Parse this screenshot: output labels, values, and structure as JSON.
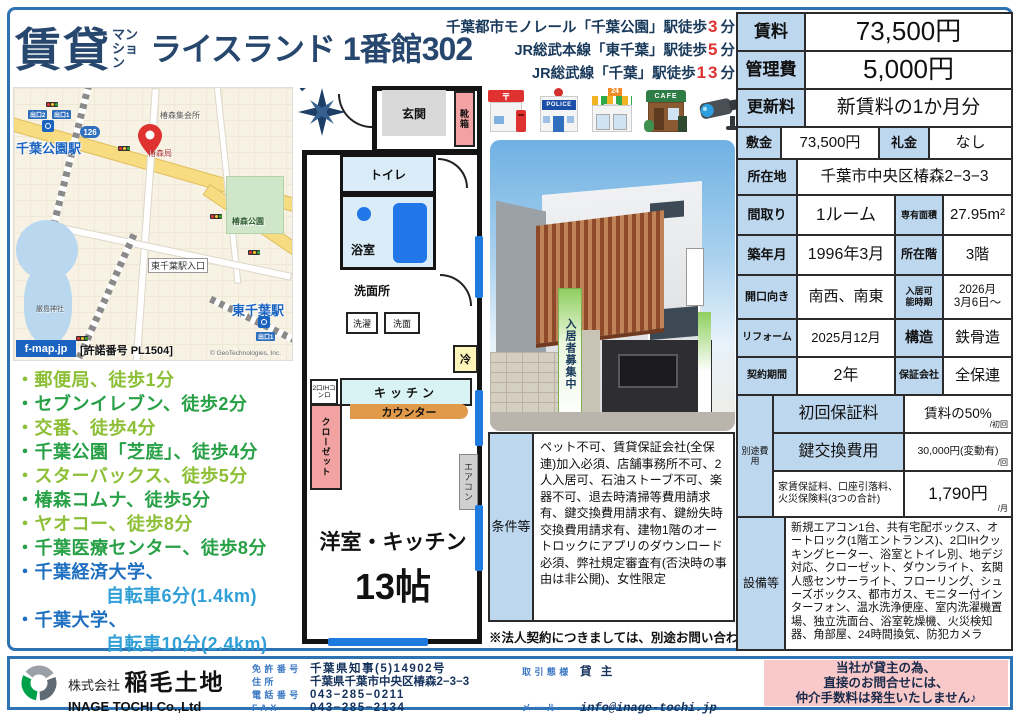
{
  "header": {
    "category": "賃貸",
    "category_sub": "マンション",
    "property": "ライスランド 1番館302"
  },
  "access": [
    {
      "text": "千葉都市モノレール「千葉公園」駅徒歩",
      "min": "3",
      "unit": "分"
    },
    {
      "text": "JR総武本線「東千葉」駅徒歩",
      "min": "5",
      "unit": "分"
    },
    {
      "text": "JR総武線「千葉」駅徒歩",
      "min": "13",
      "unit": "分"
    }
  ],
  "map": {
    "station_chibakoen": "千葉公園駅",
    "exit1": "出口1",
    "exit2": "出口2",
    "hall": "椿森集会所",
    "park": "椿森公園",
    "post": "椿森局",
    "route": "126",
    "crossing": "東千葉駅入口",
    "shrine": "厳島神社",
    "station_higashichiba": "東千葉駅",
    "exit1b": "出口1",
    "brand": "f-map.jp",
    "license": "[許諾番号 PL1504]",
    "copyright": "© GeoTechnologies, Inc."
  },
  "facilities": [
    {
      "text": "・郵便局、徒歩1分"
    },
    {
      "text": "・セブンイレブン、徒歩2分"
    },
    {
      "text": "・交番、徒歩4分"
    },
    {
      "text": "・千葉公園「芝庭」、徒歩4分"
    },
    {
      "text": "・スターバックス、徒歩5分"
    },
    {
      "text": "・椿森コムナ、徒歩5分"
    },
    {
      "text": "・ヤオコー、徒歩8分"
    },
    {
      "text": "・千葉医療センター、徒歩8分"
    },
    {
      "text": "・千葉経済大学、",
      "text2": "自転車6分(1.4km)"
    },
    {
      "text": "・千葉大学、",
      "text2": "自転車10分(2.4km)"
    }
  ],
  "icons": {
    "post_mark": "〒",
    "police_text": "POLICE",
    "store_text": "24",
    "cafe_text": "CAFE"
  },
  "photo": {
    "banner": "入居者募集中"
  },
  "floorplan": {
    "entrance": "玄関",
    "shoebox": "靴箱",
    "toilet": "トイレ",
    "bath": "浴室",
    "washroom": "洗面所",
    "washer": "洗濯",
    "basin": "洗面",
    "fridge": "冷",
    "stove": "2口IHコンロ",
    "kitchen": "キッチン",
    "counter": "カウンター",
    "closet": "クローゼット",
    "aircon": "エアコン",
    "room": "洋室・キッチン",
    "size": "13帖"
  },
  "table": {
    "rent": {
      "label": "賃料",
      "value": "73,500円"
    },
    "mgmt": {
      "label": "管理費",
      "value": "5,000円"
    },
    "renewal": {
      "label": "更新料",
      "value": "新賃料の1か月分"
    },
    "deposit": {
      "label": "敷金",
      "value": "73,500円"
    },
    "keymoney": {
      "label": "礼金",
      "value": "なし"
    },
    "address": {
      "label": "所在地",
      "value": "千葉市中央区椿森2−3−3"
    },
    "layout": {
      "label": "間取り",
      "value": "1ルーム"
    },
    "area": {
      "label": "専有面積",
      "value": "27.95m²"
    },
    "built": {
      "label": "築年月",
      "value": "1996年3月"
    },
    "floor": {
      "label": "所在階",
      "value": "3階"
    },
    "facing": {
      "label": "開口向き",
      "value": "南西、南東"
    },
    "movein": {
      "label": "入居可能時期",
      "value1": "2026月",
      "value2": "3月6日〜"
    },
    "reform": {
      "label": "リフォーム",
      "value": "2025月12月"
    },
    "structure": {
      "label": "構造",
      "value": "鉄骨造"
    },
    "term": {
      "label": "契約期間",
      "value": "2年"
    },
    "guarantor": {
      "label": "保証会社",
      "value": "全保連"
    },
    "extra": {
      "label": "別途費用",
      "rows": [
        {
          "label": "初回保証料",
          "value": "賃料の50%",
          "unit": "/初回"
        },
        {
          "label": "鍵交換費用",
          "value": "30,000円(変動有)",
          "unit": "/回"
        },
        {
          "label": "家賃保証料、口座引落料、火災保険料(3つの合計)",
          "value": "1,790円",
          "unit": "/月"
        }
      ]
    },
    "equipment": {
      "label": "設備等",
      "value": "新規エアコン1台、共有宅配ボックス、オートロック(1階エントランス)、2口IHクッキングヒーター、浴室とトイレ別、地デジ対応、クローゼット、ダウンライト、玄関人感センサーライト、フローリング、シューズボックス、都市ガス、モニター付インターフォン、温水洗浄便座、室内洗濯機置場、独立洗面台、浴室乾燥機、火災検知器、角部屋、24時間換気、防犯カメラ"
    }
  },
  "conditions": {
    "label": "条件等",
    "value": "ペット不可、賃貸保証会社(全保連)加入必須、店舗事務所不可、2人入居可、石油ストーブ不可、楽器不可、退去時清掃等費用請求有、鍵交換費用請求有、鍵紛失時交換費用請求有、建物1階のオートロックにアプリのダウンロード必須、弊社規定審査有(否決時の事由は非公開)、女性限定",
    "note": "※法人契約につきましては、別途お問い合わせください。"
  },
  "footer": {
    "company_prefix": "株式会社",
    "company_name": "稲毛土地",
    "company_en": "INAGE TOCHI Co.,Ltd",
    "license_label": "免許番号",
    "license_value": "千葉県知事(5)14902号",
    "addr_label": "住所",
    "addr_value": "千葉県千葉市中央区椿森2−3−3",
    "tel_label": "電話番号",
    "tel_value": "043−285−0211",
    "fax_label": "FAX",
    "fax_value": "043−285−2134",
    "deal_label": "取引態様",
    "deal_value": "貸主",
    "mail_label": "メール",
    "mail_value": "info@inage-tochi.jp",
    "notice1": "当社が貸主の為、",
    "notice2": "直接のお問合せには、",
    "notice3": "仲介手数料は発生いたしません♪"
  },
  "colors": {
    "title_navy": "#27476e",
    "accent_red": "#e03131",
    "label_blue": "#bdd7ee",
    "border_blue": "#2e74b5",
    "notice_pink": "#f9c9c9",
    "green_light": "#8cbf35",
    "green_dark": "#27a046",
    "univ_blue": "#1f6fc0",
    "window_blue": "#1f7ae0"
  }
}
